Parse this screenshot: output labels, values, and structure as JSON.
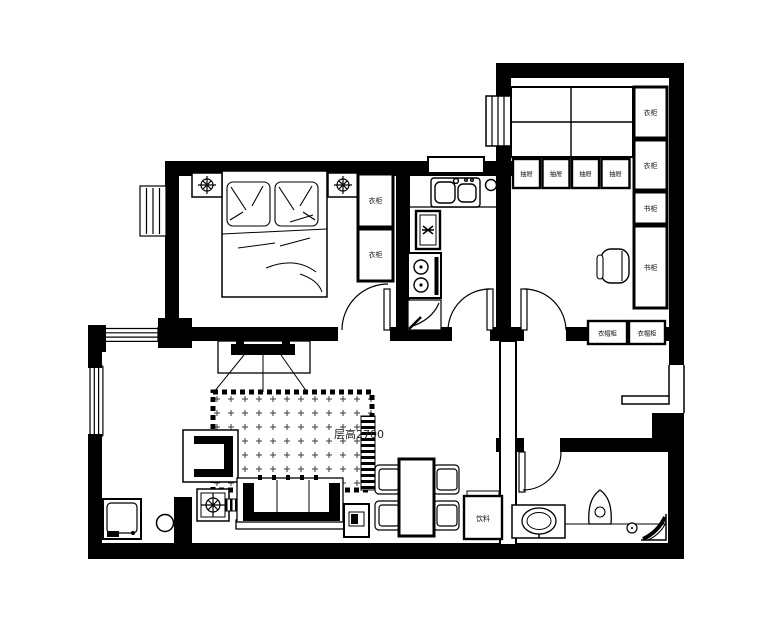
{
  "colors": {
    "line": "#000000",
    "background": "#ffffff",
    "rug_pattern": "#3a3a3a"
  },
  "labels": {
    "bedroom_wardrobe_top": "衣柜",
    "bedroom_wardrobe_bottom": "衣柜",
    "study_drawer_1": "抽屉",
    "study_drawer_2": "抽屉",
    "study_drawer_3": "抽屉",
    "study_drawer_4": "抽屉",
    "study_wardrobe_top": "衣柜",
    "study_wardrobe_mid": "衣柜",
    "study_bookcase_top": "书柜",
    "study_bookcase_bottom": "书柜",
    "study_coat_cabinet_left": "衣帽柜",
    "study_coat_cabinet_right": "衣帽柜",
    "living_ceiling_height": "层高2700",
    "dining_beverage_cabinet": "饮料"
  }
}
